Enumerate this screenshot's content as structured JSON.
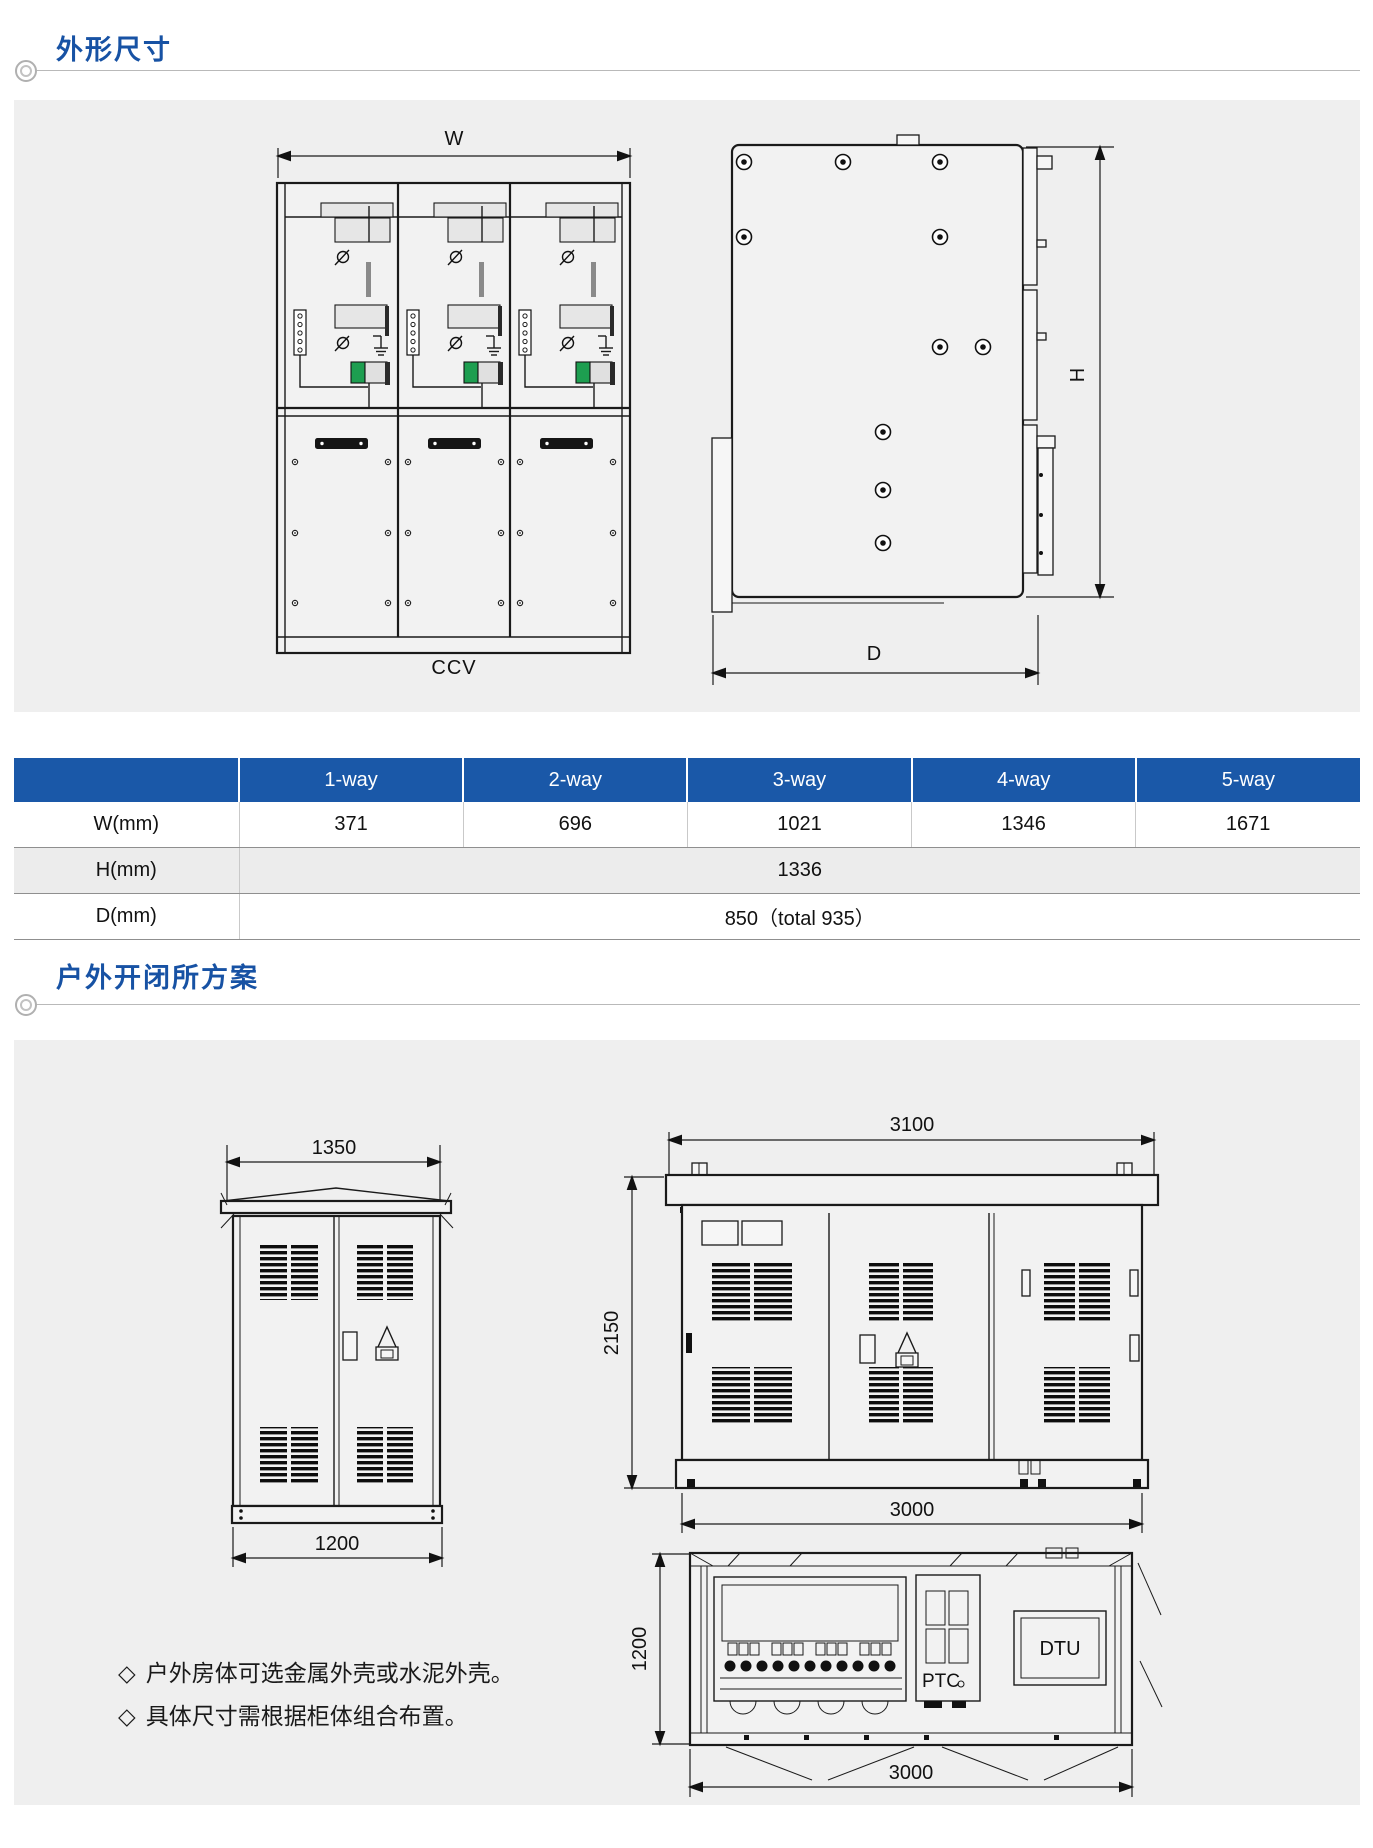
{
  "sections": {
    "dimensions": {
      "title": "外形尺寸",
      "front_view": {
        "width_label": "W",
        "caption": "CCV"
      },
      "side_view": {
        "height_label": "H",
        "depth_label": "D"
      }
    },
    "outdoor": {
      "title": "户外开闭所方案",
      "small_cabinet": {
        "top_dim": "1350",
        "bottom_dim": "1200"
      },
      "station_front": {
        "top_dim": "3100",
        "left_dim": "2150",
        "bottom_dim": "3000"
      },
      "station_plan": {
        "left_dim": "1200",
        "bottom_dim": "3000",
        "ptc_label": "PTC",
        "dtu_label": "DTU"
      },
      "notes": [
        "户外房体可选金属外壳或水泥外壳。",
        "具体尺寸需根据柜体组合布置。"
      ]
    }
  },
  "table": {
    "columns": [
      "",
      "1-way",
      "2-way",
      "3-way",
      "4-way",
      "5-way"
    ],
    "rows": {
      "w": {
        "label": "W(mm)",
        "values": [
          "371",
          "696",
          "1021",
          "1346",
          "1671"
        ]
      },
      "h": {
        "label": "H(mm)",
        "merged_value": "1336"
      },
      "d": {
        "label": "D(mm)",
        "merged_value": "850（total 935）"
      }
    }
  }
}
